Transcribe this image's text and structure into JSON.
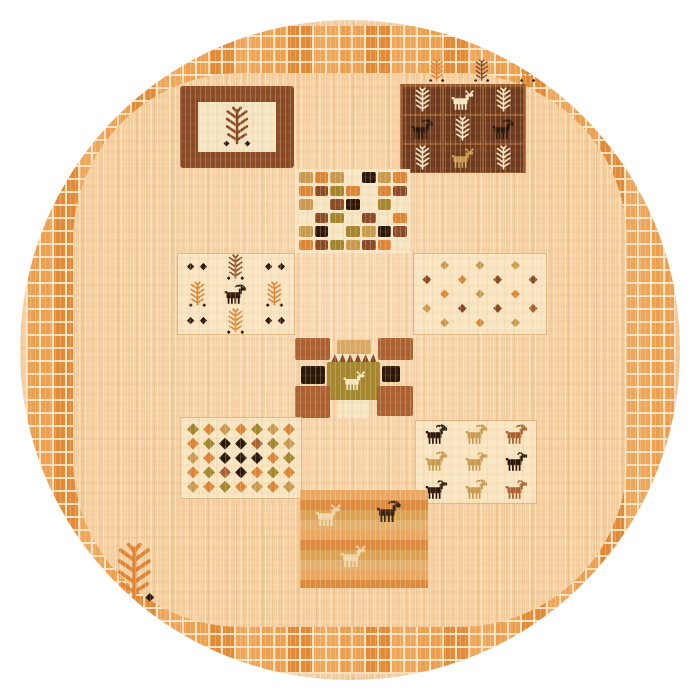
{
  "meta": {
    "subject": "round hand-knotted gabbeh style tribal area rug on white background",
    "page_background": "#ffffff",
    "rug_shape": "circle"
  },
  "palette": {
    "base": "#f6d1a3",
    "grout": "#fbe7c6",
    "border_square": "#e69140",
    "panel_light": "#f9e6c2",
    "o": "#dd8536",
    "t": "#c99a4f",
    "g": "#a3862e",
    "b": "#8a4a26",
    "r": "#ab6030",
    "k": "#2b1708",
    "c": "#f6e6c4",
    "tl": "#d9ab64",
    "br": "#6e3a1d",
    "brline": "#96582c"
  },
  "rug": {
    "border_ring": {
      "style": "mosaic of small orange squares",
      "color": "#e69140",
      "grout": "#fbe7c6"
    },
    "panels": [
      {
        "id": "framed-tree-panel",
        "type": "frame",
        "box": [
          160,
          66,
          114,
          82
        ],
        "frame_color": "b",
        "inner_color": "c",
        "motif": "tree",
        "motif_color": "b",
        "dots": "k"
      },
      {
        "id": "tree-sprigs-row",
        "type": "sprigs",
        "box": [
          408,
          35,
          108,
          28
        ],
        "items": [
          "tree:o",
          "tree:b",
          "tree:o"
        ],
        "dots": "k",
        "item_h": 24
      },
      {
        "id": "animal-tree-grid-panel",
        "type": "motif-grid",
        "box": [
          380,
          64,
          126,
          89
        ],
        "bg": "br",
        "line": "brline",
        "rows": [
          [
            "tree:c",
            "deer:c",
            "tree:c"
          ],
          [
            "goat:k",
            "tree:c",
            "goat:k"
          ],
          [
            "tree:c",
            "horse:t",
            "tree:c"
          ]
        ]
      },
      {
        "id": "checkerboard-panel",
        "type": "checker",
        "box": [
          276,
          149,
          114,
          84
        ],
        "rows": [
          [
            "t",
            "o",
            "t",
            "c",
            "k",
            "t",
            "o"
          ],
          [
            "o",
            "b",
            "g",
            "o",
            "c",
            "o",
            "b"
          ],
          [
            "t",
            "c",
            "b",
            "k",
            "c",
            "g",
            "c"
          ],
          [
            "c",
            "b",
            "g",
            "c",
            "b",
            "c",
            "o"
          ],
          [
            "t",
            "k",
            "c",
            "g",
            "t",
            "k",
            "b"
          ],
          [
            "o",
            "b",
            "g",
            "t",
            "b",
            "o",
            "c"
          ]
        ]
      },
      {
        "id": "trees-goat-panel",
        "type": "motif-grid",
        "box": [
          157,
          233,
          118,
          82
        ],
        "bg": "panel_light",
        "light": true,
        "rows": [
          [
            "dots:k",
            "tree:b",
            "dots:k"
          ],
          [
            "tree:o",
            "goat:k",
            "tree:o"
          ],
          [
            "dots:k",
            "tree:o",
            "dots:k"
          ]
        ]
      },
      {
        "id": "scatter-diamonds-panel",
        "type": "diamonds",
        "box": [
          393,
          233,
          134,
          82
        ],
        "bg": "panel_light",
        "size": 9,
        "rows": [
          [
            ".",
            "t",
            ".",
            "t",
            ".",
            "t",
            "."
          ],
          [
            "b",
            ".",
            "o",
            ".",
            "b",
            ".",
            "b"
          ],
          [
            ".",
            "o",
            ".",
            "t",
            ".",
            "o",
            "."
          ],
          [
            "t",
            ".",
            "b",
            ".",
            "b",
            ".",
            "r"
          ],
          [
            ".",
            "t",
            ".",
            "o",
            ".",
            "t",
            "."
          ]
        ]
      },
      {
        "id": "center-medallion",
        "type": "medallion",
        "box": [
          275,
          318,
          118,
          82
        ],
        "center_motif": "deer",
        "center_motif_color": "c",
        "blocks": [
          {
            "x": 0,
            "y": 0,
            "w": 35,
            "h": 22,
            "c": "r",
            "name": "corner-block"
          },
          {
            "x": 42,
            "y": 2,
            "w": 34,
            "h": 15,
            "c": "tl",
            "name": "top-block"
          },
          {
            "x": 36,
            "y": 16,
            "w": 46,
            "h": 9,
            "c": "cren",
            "name": "crenellation-strip"
          },
          {
            "x": 83,
            "y": 0,
            "w": 35,
            "h": 22,
            "c": "r",
            "name": "corner-block"
          },
          {
            "x": 6,
            "y": 28,
            "w": 24,
            "h": 18,
            "c": "k",
            "name": "side-block"
          },
          {
            "x": 32,
            "y": 24,
            "w": 53,
            "h": 38,
            "c": "g",
            "name": "center-block",
            "motif": true
          },
          {
            "x": 87,
            "y": 28,
            "w": 18,
            "h": 16,
            "c": "k",
            "name": "side-block"
          },
          {
            "x": 0,
            "y": 48,
            "w": 35,
            "h": 32,
            "c": "r",
            "name": "corner-block"
          },
          {
            "x": 42,
            "y": 62,
            "w": 32,
            "h": 18,
            "c": "c",
            "name": "bottom-block"
          },
          {
            "x": 82,
            "y": 48,
            "w": 36,
            "h": 30,
            "c": "r",
            "name": "corner-block"
          }
        ]
      },
      {
        "id": "dense-diamonds-panel",
        "type": "diamonds",
        "box": [
          160,
          397,
          122,
          82
        ],
        "bg": "panel_light",
        "size": 12,
        "rows": [
          [
            "g",
            "o",
            "t",
            "o",
            "g",
            "t",
            "o"
          ],
          [
            "o",
            "g",
            "k",
            "k",
            "r",
            "g",
            "t"
          ],
          [
            "t",
            "o",
            "k",
            "k",
            "k",
            "o",
            "g"
          ],
          [
            "o",
            "g",
            "r",
            "k",
            "o",
            "g",
            "o"
          ],
          [
            "t",
            "o",
            "g",
            "o",
            "t",
            "o",
            "t"
          ]
        ]
      },
      {
        "id": "herd-panel",
        "type": "motif-grid",
        "box": [
          395,
          400,
          122,
          84
        ],
        "bg": "panel_light",
        "light": true,
        "rows": [
          [
            "goat:k",
            "goat:t",
            "goat:r"
          ],
          [
            "goat:t",
            "sheep:t",
            "sheep:k"
          ],
          [
            "sheep:k",
            "goat:t",
            "sheep:r"
          ]
        ]
      },
      {
        "id": "pasture-panel",
        "type": "striped",
        "box": [
          280,
          470,
          128,
          98
        ],
        "stripes": [
          "#e9a55c",
          "#dd8536",
          "#daa04e",
          "#e2b06b"
        ],
        "motifs": [
          {
            "m": "horse",
            "c": "c",
            "x": 10,
            "y": 14
          },
          {
            "m": "goat",
            "c": "k",
            "x": 58,
            "y": 10
          },
          {
            "m": "horse",
            "c": "c",
            "x": 30,
            "y": 56
          }
        ]
      },
      {
        "id": "lone-tree",
        "type": "sprigs",
        "box": [
          92,
          518,
          58,
          66
        ],
        "items": [
          "tree:o"
        ],
        "dots": "k",
        "item_h": 62
      }
    ]
  }
}
